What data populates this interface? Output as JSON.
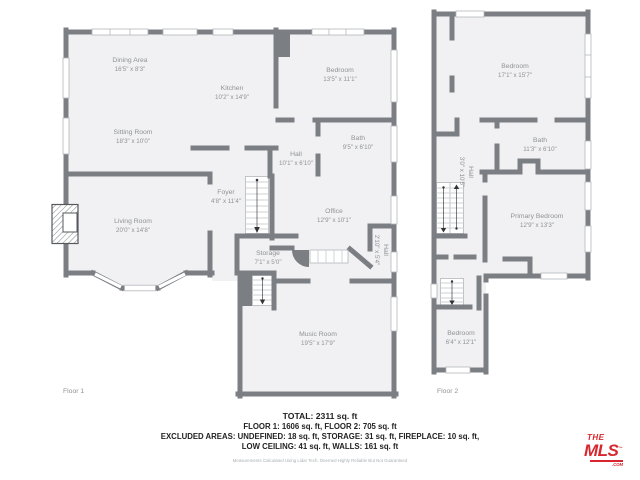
{
  "floor_plan": {
    "floor1": {
      "label": "Floor 1",
      "rooms": {
        "dining": {
          "name": "Dining Area",
          "dims": "16'5\" x 8'3\""
        },
        "kitchen": {
          "name": "Kitchen",
          "dims": "10'2\" x 14'9\""
        },
        "sitting": {
          "name": "Sitting Room",
          "dims": "18'3\" x 10'0\""
        },
        "bedroom": {
          "name": "Bedroom",
          "dims": "13'5\" x 11'1\""
        },
        "bath": {
          "name": "Bath",
          "dims": "9'5\" x 6'10\""
        },
        "hall": {
          "name": "Hall",
          "dims": "10'1\" x 6'10\""
        },
        "foyer": {
          "name": "Foyer",
          "dims": "4'8\" x 11'4\""
        },
        "living": {
          "name": "Living Room",
          "dims": "20'0\" x 14'8\""
        },
        "office": {
          "name": "Office",
          "dims": "12'9\" x 10'1\""
        },
        "storage": {
          "name": "Storage",
          "dims": "7'1\" x 5'0\""
        },
        "hall2": {
          "name": "Hall",
          "dims": "2'10\" x 5'4\""
        },
        "music": {
          "name": "Music Room",
          "dims": "19'5\" x 17'9\""
        }
      }
    },
    "floor2": {
      "label": "Floor 2",
      "rooms": {
        "bedroom1": {
          "name": "Bedroom",
          "dims": "17'1\" x 15'7\""
        },
        "bath": {
          "name": "Bath",
          "dims": "11'3\" x 6'10\""
        },
        "hall": {
          "name": "Hall",
          "dims": "3'0\" x 10'5\""
        },
        "primary": {
          "name": "Primary Bedroom",
          "dims": "12'9\" x 13'3\""
        },
        "bedroom2": {
          "name": "Bedroom",
          "dims": "6'4\" x 12'1\""
        }
      }
    },
    "summary": {
      "total": "TOTAL: 2311 sq. ft",
      "floors": "FLOOR 1: 1606 sq. ft, FLOOR 2: 705 sq. ft",
      "excluded1": "EXCLUDED AREAS: UNDEFINED: 18 sq. ft, STORAGE: 31 sq. ft, FIREPLACE: 10 sq. ft,",
      "excluded2": "LOW CEILING: 41 sq. ft, WALLS: 161 sq. ft",
      "disclaimer": "Measurements Calculated Using Lidar Tech. Deemed Highly Reliable But Not Guaranteed"
    },
    "logo": {
      "the": "THE",
      "mls": "MLS",
      "tm": "™",
      "com": ".COM"
    },
    "colors": {
      "wall": "#7b7e83",
      "room_fill": "#f1f1f3",
      "label_text": "#8f9296",
      "logo_red": "#d7262d"
    }
  }
}
